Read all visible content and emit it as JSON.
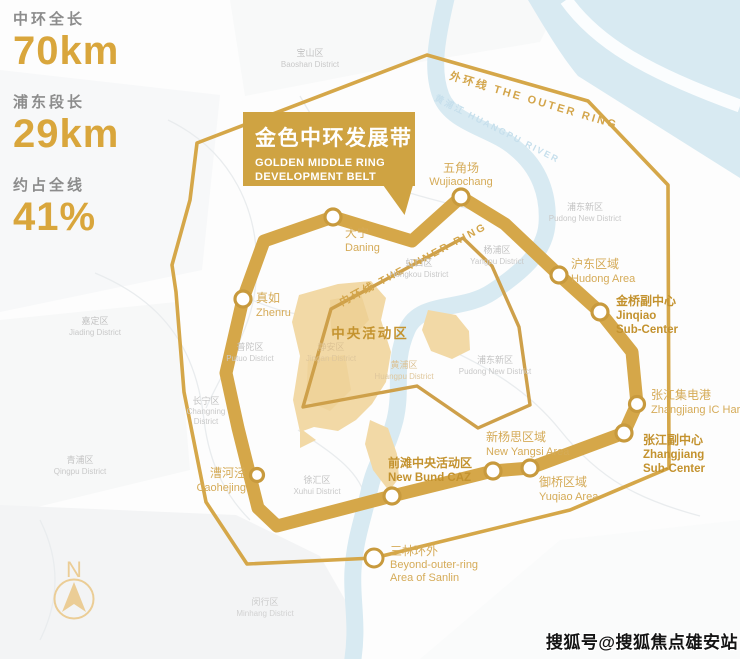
{
  "stats": [
    {
      "label": "中环全长",
      "value": "70km"
    },
    {
      "label": "浦东段长",
      "value": "29km"
    },
    {
      "label": "约占全线",
      "value": "41%"
    }
  ],
  "banner": {
    "title_cn": "金色中环发展带",
    "title_en_line1": "GOLDEN MIDDLE RING",
    "title_en_line2": "DEVELOPMENT BELT"
  },
  "rings": {
    "outer_label": "外环线  THE OUTER RING",
    "inner_label": "内环线  THE INNER RING"
  },
  "river_label": "黄浦江 HUANGPU RIVER",
  "caz_label": "中央活动区",
  "stations": {
    "daning": {
      "cn": "大宁",
      "en": "Daning"
    },
    "wujiaochang": {
      "cn": "五角场",
      "en": "Wujiaochang"
    },
    "zhenru": {
      "cn": "真如",
      "en": "Zhenru"
    },
    "hudong": {
      "cn": "沪东区域",
      "en": "Hudong Area"
    },
    "jinqiao": {
      "cn": "金桥副中心",
      "en1": "Jinqiao",
      "en2": "Sub-Center"
    },
    "zhangjiang_ic": {
      "cn": "张江集电港",
      "en": "Zhangjiang IC Harbor"
    },
    "zhangjiang_sub": {
      "cn": "张江副中心",
      "en1": "Zhangjiang",
      "en2": "Sub-Center"
    },
    "yuqiao": {
      "cn": "御桥区域",
      "en": "Yuqiao Area"
    },
    "new_yangsi": {
      "cn": "新杨思区域",
      "en": "New Yangsi Area"
    },
    "new_bund": {
      "cn": "前滩中央活动区",
      "en": "New Bund CAZ"
    },
    "caohejing": {
      "cn": "漕河泾",
      "en": "Caohejing"
    },
    "sanlin": {
      "cn": "三林环外",
      "en1": "Beyond-outer-ring",
      "en2": "Area of Sanlin"
    }
  },
  "districts": {
    "baoshan": {
      "cn": "宝山区",
      "en": "Baoshan District"
    },
    "jiading": {
      "cn": "嘉定区",
      "en": "Jiading District"
    },
    "qingpu": {
      "cn": "青浦区",
      "en": "Qingpu District"
    },
    "putuo": {
      "cn": "普陀区",
      "en": "Putuo District"
    },
    "changning": {
      "cn": "长宁区",
      "en1": "Changning",
      "en2": "District"
    },
    "hongkou": {
      "cn": "虹口区",
      "en": "Hongkou District"
    },
    "yangpu": {
      "cn": "杨浦区",
      "en": "Yangpu District"
    },
    "pudong_ne": {
      "cn": "浦东新区",
      "en": "Pudong New District"
    },
    "pudong_center": {
      "cn": "浦东新区",
      "en": "Pudong New District"
    },
    "jingan": {
      "cn": "静安区",
      "en": "Jingan District"
    },
    "huangpu": {
      "cn": "黄浦区",
      "en": "Huangpu District"
    },
    "xuhui": {
      "cn": "徐汇区",
      "en": "Xuhui District"
    },
    "minhang": {
      "cn": "闵行区",
      "en": "Minhang District"
    }
  },
  "compass": {
    "label": "N"
  },
  "watermark": "搜狐号@搜狐焦点雄安站",
  "colors": {
    "ring_gold": "#d5a749",
    "banner_gold": "#cfa342",
    "label_gold_light": "#d5ab58",
    "label_gold_strong": "#c3922e",
    "caz_beige": "#f2d9a6",
    "river_blue": "#d8eaf2",
    "district_gray": "#c3c3c3",
    "stat_value_gold": "#d9a63c",
    "stat_label_gray": "#8c8c8c"
  }
}
